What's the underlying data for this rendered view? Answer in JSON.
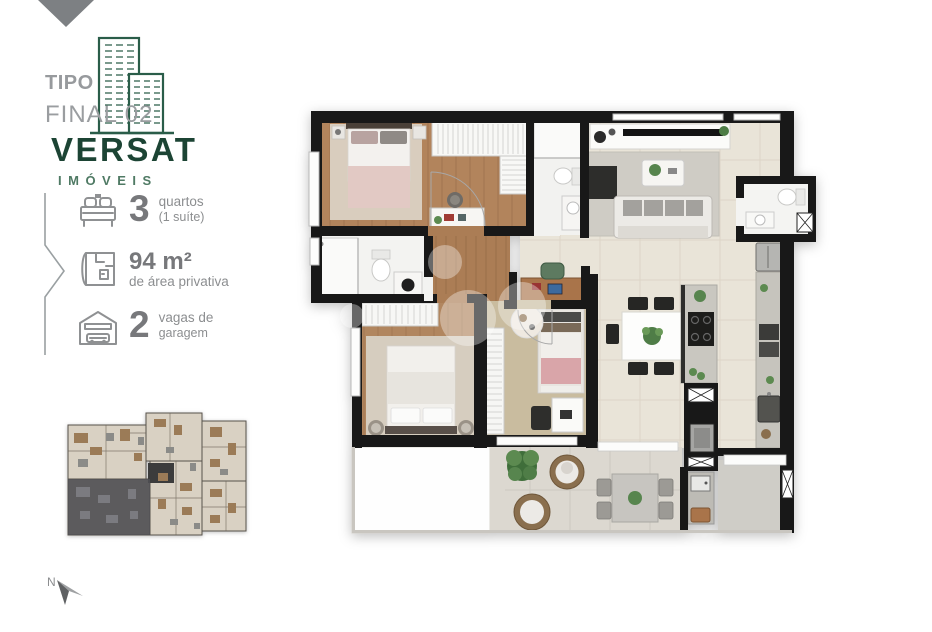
{
  "logo": {
    "tipo": "TIPO",
    "final": "FINAL 02",
    "brand": "VERSAT",
    "brand_sub": "IMÓVEIS",
    "brand_color": "#1c4434",
    "sub_color": "#4f7a64",
    "muted_color": "#9a9da0"
  },
  "features": [
    {
      "icon": "bed-icon",
      "value": "3",
      "label": "quartos",
      "sublabel": "(1 suíte)"
    },
    {
      "icon": "floorplan-icon",
      "value": "94 m²",
      "label": "de área privativa",
      "sublabel": ""
    },
    {
      "icon": "garage-icon",
      "value": "2",
      "label": "vagas de",
      "sublabel": "garagem"
    }
  ],
  "north": {
    "label": "N"
  },
  "key_plan": {
    "highlight_color": "#4e4e52",
    "base_color": "#d9d1c3"
  },
  "floor_plan": {
    "wall_color": "#181818",
    "wood_color": "#b2845c",
    "tile_color": "#e9e4d8",
    "balcony_tile_color": "#dcd8d0",
    "rug_color": "#d6cdbf",
    "accent_plant_color": "#57854e",
    "accent_pink_color": "#dca8ac"
  }
}
